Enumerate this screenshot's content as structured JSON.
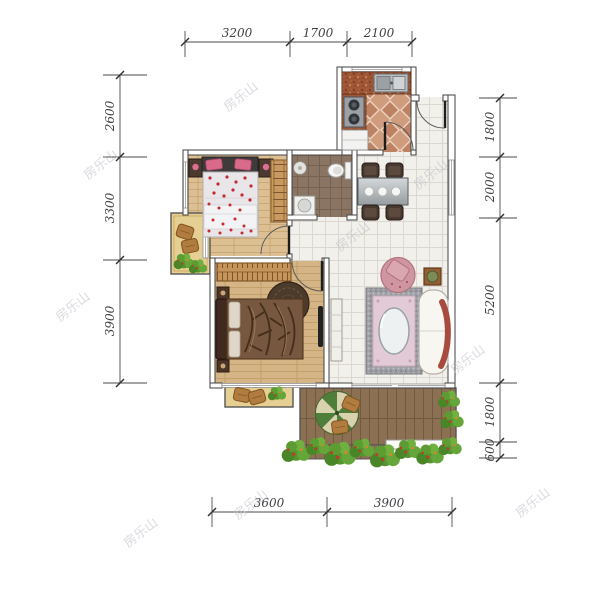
{
  "watermark": {
    "text": "房乐山"
  },
  "dimensions": {
    "top": [
      "3200",
      "1700",
      "2100"
    ],
    "left": [
      "2600",
      "3300",
      "3900"
    ],
    "right": [
      "1800",
      "2000",
      "5200",
      "1800",
      "600"
    ],
    "bottom": [
      "3600",
      "3900"
    ]
  },
  "palette": {
    "wall_outline": "#424242",
    "tile_floor": "#f2f0eb",
    "bedroom_wood": "#dcc093",
    "master_wood": "#d5b586",
    "deck_wood": "#8b7053",
    "kitchen_tile": "#bd8164",
    "bath_tile": "#8a7463",
    "balcony_tan": "#e6cf92",
    "bed_floral_red": "#c32b35",
    "rug_pink": "#e2cbd6",
    "sofa_blanket": "#a84b3e",
    "umbrella_green": "#4e7f3a",
    "umbrella_cream": "#d9d2ae",
    "shrub_green": "#57942f",
    "dim_text": "#3f3f44",
    "watermark_gray": "#b9bcc4"
  }
}
